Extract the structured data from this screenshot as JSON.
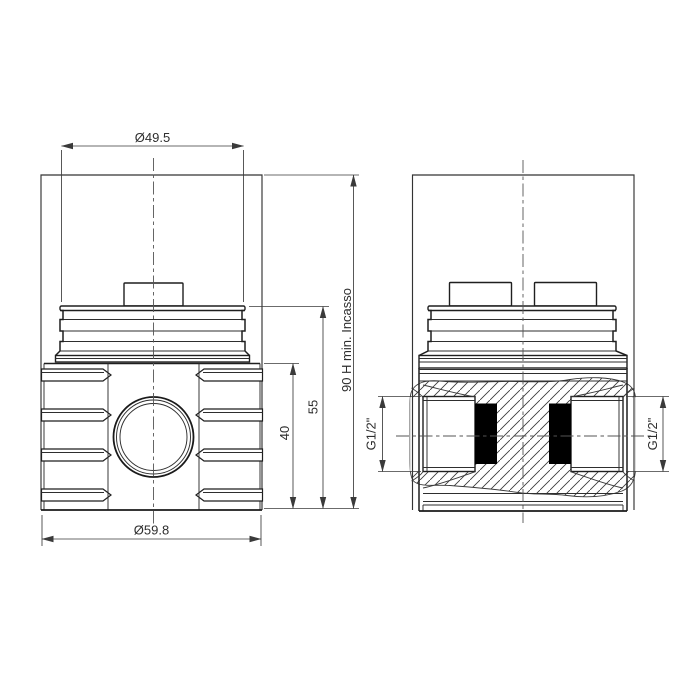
{
  "drawing": {
    "type": "technical-drawing",
    "background": "#ffffff",
    "line_color": "#1f1f1f",
    "dim_color": "#3a3a3a",
    "front_view": {
      "name": "front view of recessed valve body",
      "dim_top_diameter": "Ø49.5",
      "dim_bottom_diameter": "Ø59.8",
      "dim_body_height": "40",
      "dim_cartridge_height": "55",
      "dim_recess_depth": "90 H min. Incasso"
    },
    "side_view": {
      "name": "side section view with threaded ports",
      "dim_port_left": "G1/2\"",
      "dim_port_right": "G1/2\""
    }
  }
}
